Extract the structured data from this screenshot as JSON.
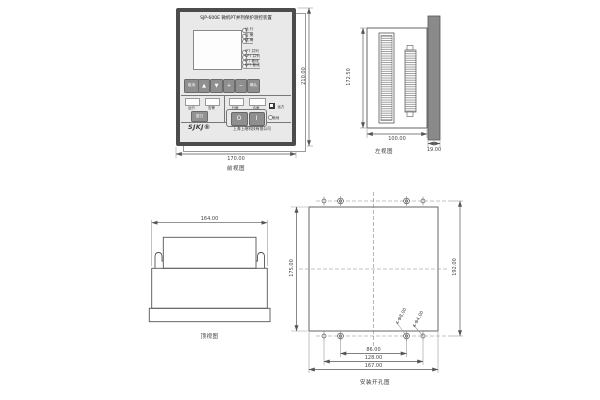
{
  "front_view": {
    "title_label": "前视图",
    "dim_width": "170.00",
    "dim_height": "210.00",
    "panel": {
      "model_title": "SJP-600E  微机PT并列保护测控装置",
      "status_leds": [
        "运 行",
        "告 警",
        "跳 闸"
      ],
      "pt_leds": [
        "IPT 并列",
        "IIPT 并列",
        "IPT 断线",
        "IIPT 断线"
      ],
      "keys": [
        "取消",
        "▲",
        "▼",
        "+",
        "−",
        "确认"
      ],
      "signal_windows": [
        "运行",
        "告警"
      ],
      "reset_button": "复归",
      "control_windows": [
        "分闸",
        "合闸"
      ],
      "open_button": "O",
      "close_button": "I",
      "switch_top": "远方",
      "switch_bottom": "就地",
      "logo": "SJKJ®",
      "company": "上海上继科技有限公司"
    }
  },
  "left_view": {
    "title_label": "左视图",
    "dim_height": "172.50",
    "dim_width": "100.00",
    "dim_panel": "19.00"
  },
  "top_view": {
    "title_label": "顶视图",
    "dim_width": "164.00"
  },
  "install_view": {
    "title_label": "安装开孔图",
    "dim_height_left": "175.00",
    "dim_height_right": "192.00",
    "dim_span_inner": "86.00",
    "dim_span_mid": "128.00",
    "dim_span_outer": "167.00",
    "hole_label_inner": "4-Φ8.00",
    "hole_label_outer": "4-Φ4.00"
  },
  "colors": {
    "case_frame": "#4c4c4c",
    "panel_face": "#e9e9e9",
    "side_panel_bar": "#8a8a8a",
    "drawing_line": "#555555",
    "dimension_text": "#444444"
  }
}
